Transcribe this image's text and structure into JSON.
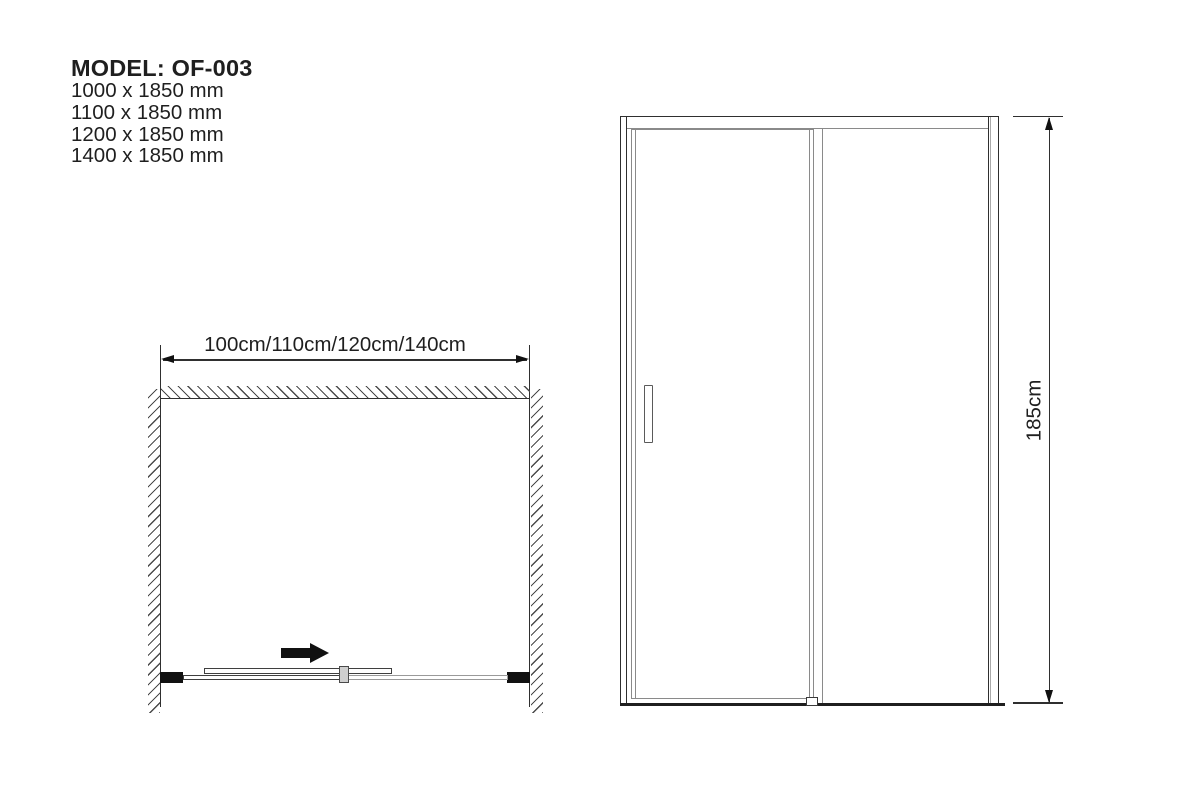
{
  "header": {
    "model_title": "MODEL: OF-003",
    "sizes": [
      "1000 x 1850 mm",
      "1100 x 1850 mm",
      "1200 x 1850 mm",
      "1400 x 1850 mm"
    ]
  },
  "plan_view": {
    "view_type": "top view of sliding shower door between two walls",
    "width_dimension_label": "100cm/110cm/120cm/140cm",
    "slide_direction": "right"
  },
  "elevation_view": {
    "view_type": "front view of sliding door with fixed panel",
    "height_dimension_label": "185cm"
  },
  "colors": {
    "ink": "#1f1f1f",
    "frame_gray": "#8a8a8a",
    "hatch": "#4a4a4a",
    "fill": "#ffffff"
  }
}
